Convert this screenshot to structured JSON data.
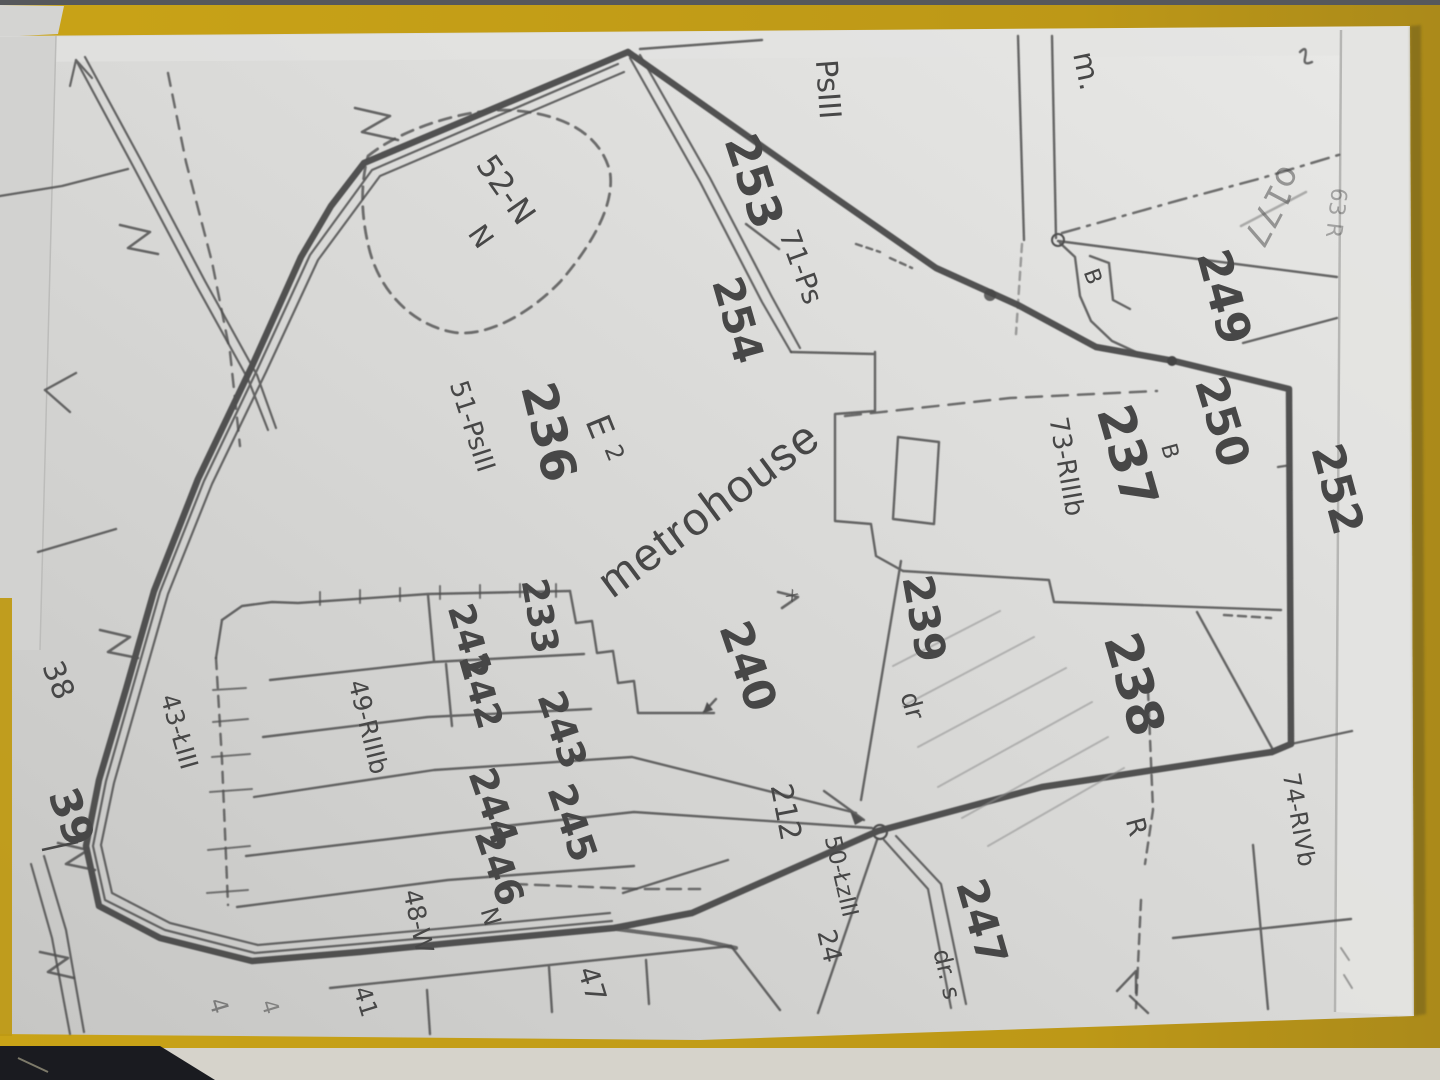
{
  "photo": {
    "description": "photographed paper cadastral map on yellow folder",
    "watermark": {
      "text": "metrohouse"
    }
  },
  "colors": {
    "background_yellow": "#c19b16",
    "paper": "#d9d9d7",
    "ink": "#4f4f4f",
    "dark_corner": "#1a1b20"
  },
  "labels": [
    {
      "text": "PsIII"
    },
    {
      "text": "253"
    },
    {
      "text": "71-Ps"
    },
    {
      "text": "254"
    },
    {
      "text": "52-N"
    },
    {
      "text": "N"
    },
    {
      "text": "m."
    },
    {
      "text": "249"
    },
    {
      "text": "o177"
    },
    {
      "text": "63 R"
    },
    {
      "text": "B"
    },
    {
      "text": "250"
    },
    {
      "text": "237"
    },
    {
      "text": "73-RIIIb"
    },
    {
      "text": "B"
    },
    {
      "text": "252"
    },
    {
      "text": "236"
    },
    {
      "text": "51-PsIII"
    },
    {
      "text": "E"
    },
    {
      "text": "2"
    },
    {
      "text": "233"
    },
    {
      "text": "241"
    },
    {
      "text": "242"
    },
    {
      "text": "243"
    },
    {
      "text": "244"
    },
    {
      "text": "245"
    },
    {
      "text": "246"
    },
    {
      "text": "49-RIIIb"
    },
    {
      "text": "240"
    },
    {
      "text": "239"
    },
    {
      "text": "dr"
    },
    {
      "text": "238"
    },
    {
      "text": "R"
    },
    {
      "text": "212"
    },
    {
      "text": "50-ŁzIII"
    },
    {
      "text": "24"
    },
    {
      "text": "247"
    },
    {
      "text": "dr. s"
    },
    {
      "text": "74-RIVb"
    },
    {
      "text": "38"
    },
    {
      "text": "39"
    },
    {
      "text": "43-ŁIII"
    },
    {
      "text": "48-W"
    },
    {
      "text": "N"
    },
    {
      "text": "47"
    },
    {
      "text": "41"
    },
    {
      "text": "4"
    },
    {
      "text": "4"
    },
    {
      "text": "x"
    }
  ]
}
